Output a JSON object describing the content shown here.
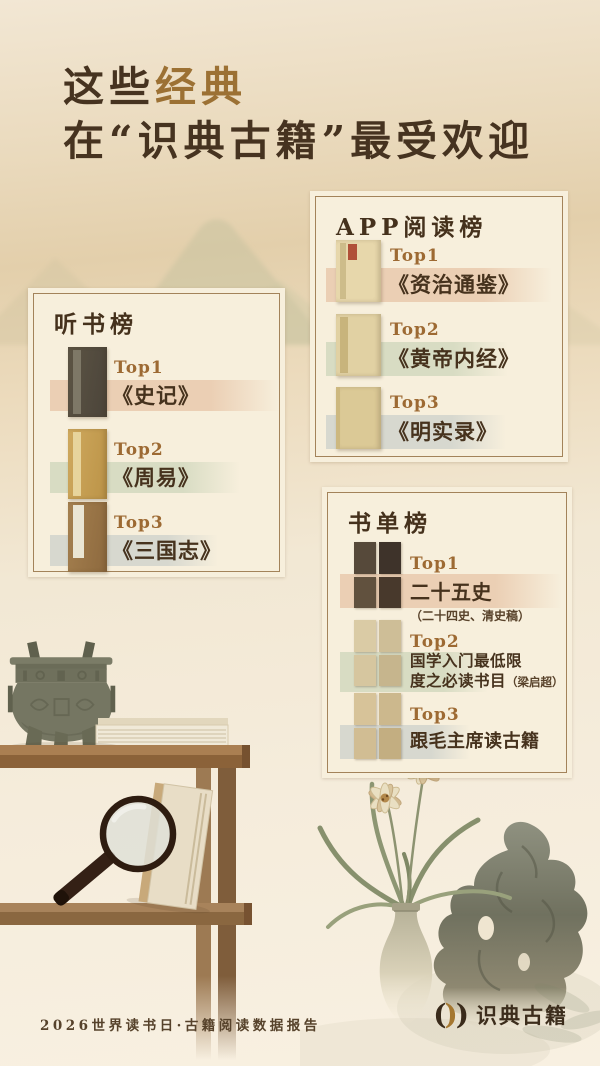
{
  "page": {
    "title": {
      "part1": "这些",
      "part2": "经典",
      "line2": "在“识典古籍”最受欢迎"
    },
    "footer": {
      "report": "2026世界读书日·古籍阅读数据报告",
      "brand": "识典古籍",
      "mark_left": "(",
      "mark_mid": ")",
      "mark_right": ")"
    }
  },
  "colors": {
    "accent_gold": "#9c7134",
    "ink": "#46321d",
    "rank_gold": "#9d6a33",
    "band_peach": "#ebcfb4",
    "band_sage": "#d8dcc3",
    "band_gray": "#d7d8cf",
    "panel_bg": "#f7efdc",
    "panel_border": "#a3835a"
  },
  "boards": [
    {
      "id": "listen",
      "title": "听书榜",
      "entries": [
        {
          "rank": "Top1",
          "title": "《史记》"
        },
        {
          "rank": "Top2",
          "title": "《周易》"
        },
        {
          "rank": "Top3",
          "title": "《三国志》"
        }
      ]
    },
    {
      "id": "app",
      "title": "APP阅读榜",
      "entries": [
        {
          "rank": "Top1",
          "title": "《资治通鉴》"
        },
        {
          "rank": "Top2",
          "title": "《黄帝内经》"
        },
        {
          "rank": "Top3",
          "title": "《明实录》"
        }
      ]
    },
    {
      "id": "booklist",
      "title": "书单榜",
      "entries": [
        {
          "rank": "Top1",
          "title": "二十五史",
          "subtitle": "（二十四史、清史稿）"
        },
        {
          "rank": "Top2",
          "title": "国学入门最低限\n度之必读书目",
          "subtitle": "（梁启超）"
        },
        {
          "rank": "Top3",
          "title": "跟毛主席读古籍",
          "subtitle": ""
        }
      ]
    }
  ],
  "decor": {
    "items": [
      "bronze-ding",
      "book-stack",
      "wooden-shelf",
      "magnifying-glass",
      "standing-book",
      "orchid-vase",
      "scholar-rock",
      "mountain-wash"
    ]
  }
}
